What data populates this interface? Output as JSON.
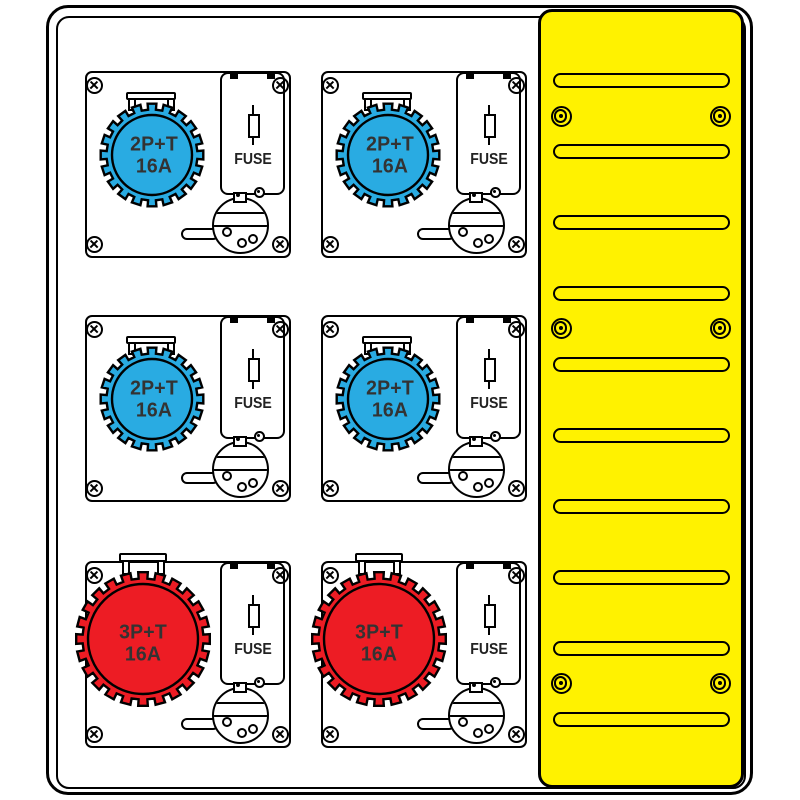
{
  "illustration": {
    "type": "distribution-board-technical-drawing",
    "colors": {
      "socket_blue": "#29ABE2",
      "socket_red": "#ED1C24",
      "panel_yellow": "#FFF200",
      "label_text": "#333333"
    },
    "modules": [
      {
        "socket_color": "blue",
        "line1": "2P+T",
        "line2": "16A",
        "fuse_label": "FUSE"
      },
      {
        "socket_color": "blue",
        "line1": "2P+T",
        "line2": "16A",
        "fuse_label": "FUSE"
      },
      {
        "socket_color": "blue",
        "line1": "2P+T",
        "line2": "16A",
        "fuse_label": "FUSE"
      },
      {
        "socket_color": "blue",
        "line1": "2P+T",
        "line2": "16A",
        "fuse_label": "FUSE"
      },
      {
        "socket_color": "red",
        "line1": "3P+T",
        "line2": "16A",
        "fuse_label": "FUSE"
      },
      {
        "socket_color": "red",
        "line1": "3P+T",
        "line2": "16A",
        "fuse_label": "FUSE"
      }
    ],
    "vent_panel": {
      "slot_count": 10,
      "screw_count": 6
    }
  }
}
